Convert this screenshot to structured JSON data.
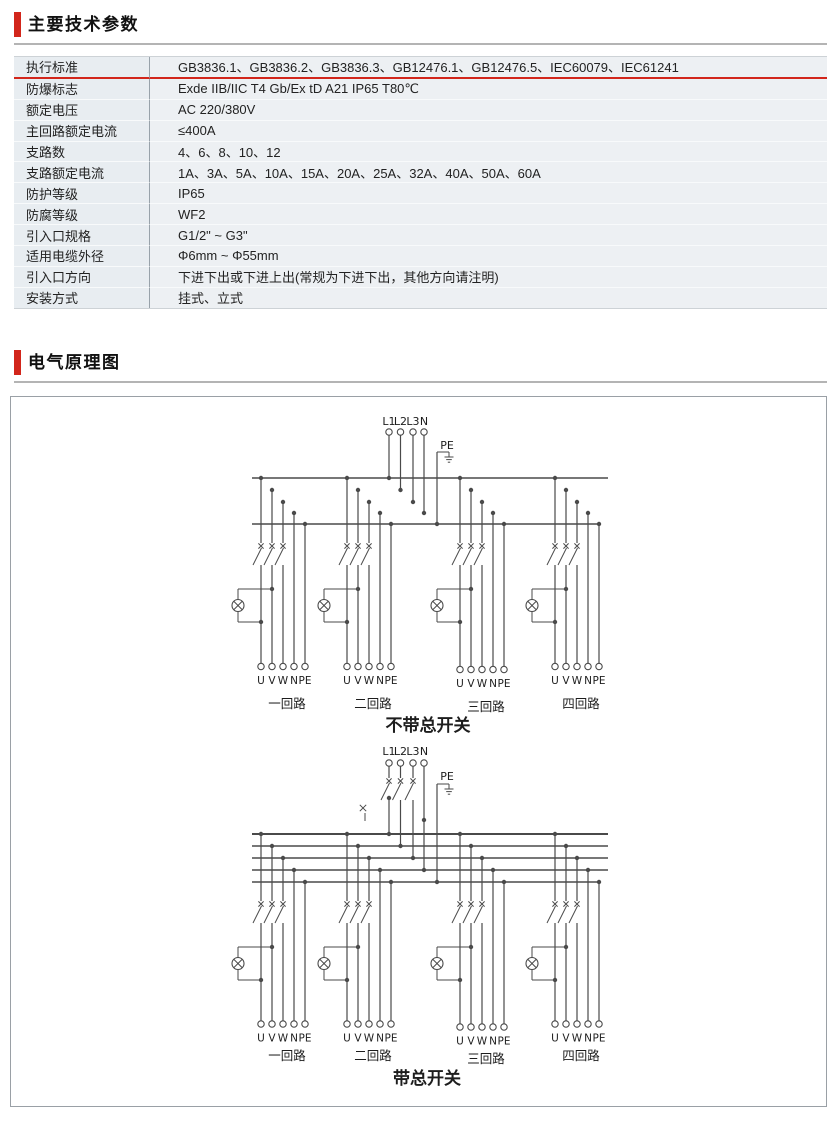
{
  "page": {
    "accent_red": "#d2261b",
    "rule_gray": "#b4b4b4",
    "diagram": {
      "line": "#4a4a4a",
      "text": "#1d1d1d"
    }
  },
  "sections": {
    "specs": {
      "title": "主要技术参数"
    },
    "schematic": {
      "title": "电气原理图"
    }
  },
  "spec_table": {
    "rows": [
      {
        "label": "执行标准",
        "value": "GB3836.1、GB3836.2、GB3836.3、GB12476.1、GB12476.5、IEC60079、IEC61241",
        "highlight": true
      },
      {
        "label": "防爆标志",
        "value": "Exde IIB/IIC T4 Gb/Ex tD A21 IP65 T80℃"
      },
      {
        "label": "额定电压",
        "value": "AC 220/380V"
      },
      {
        "label": "主回路额定电流",
        "value": "≤400A"
      },
      {
        "label": "支路数",
        "value": "4、6、8、10、12"
      },
      {
        "label": "支路额定电流",
        "value": "1A、3A、5A、10A、15A、20A、25A、32A、40A、50A、60A"
      },
      {
        "label": "防护等级",
        "value": "IP65"
      },
      {
        "label": "防腐等级",
        "value": "WF2"
      },
      {
        "label": "引入口规格",
        "value": "G1/2\" ~ G3\""
      },
      {
        "label": "适用电缆外径",
        "value": "Φ6mm ~ Φ55mm"
      },
      {
        "label": "引入口方向",
        "value": "下进下出或下进上出(常规为下进下出，其他方向请注明)"
      },
      {
        "label": "安装方式",
        "value": "挂式、立式"
      }
    ]
  },
  "schematics": {
    "incoming_labels": [
      "L1",
      "L2",
      "L3",
      "N"
    ],
    "pe_label": "PE",
    "terminal_labels": [
      "U",
      "V",
      "W",
      "N",
      "PE"
    ],
    "branch_captions": [
      "一回路",
      "二回路",
      "三回路",
      "四回路"
    ],
    "diagrams": [
      {
        "caption": "不带总开关",
        "has_main_switch": false
      },
      {
        "caption": "带总开关",
        "has_main_switch": true
      }
    ]
  }
}
